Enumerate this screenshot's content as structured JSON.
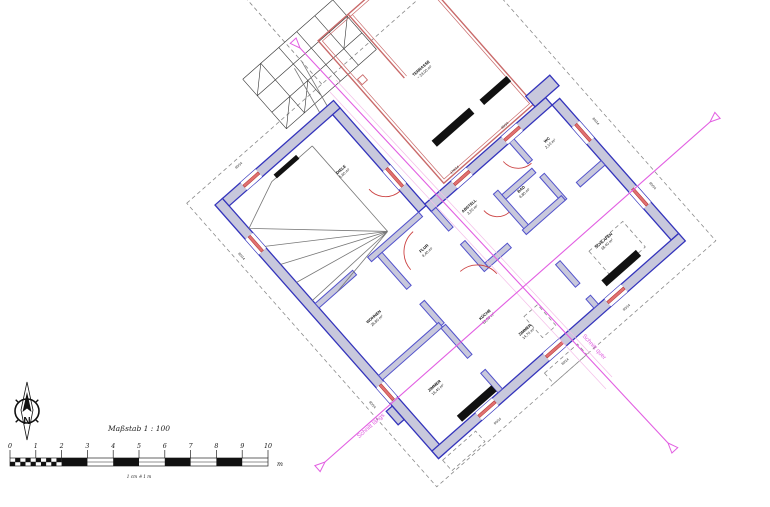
{
  "title_block": {
    "scale_title": "Maßstab 1 : 100",
    "scale_sub": "1 cm ≙ 1 m",
    "unit": "m"
  },
  "scalebar": {
    "ticks": [
      "0",
      "1",
      "2",
      "3",
      "4",
      "5",
      "6",
      "7",
      "8",
      "9",
      "10"
    ]
  },
  "compass": {
    "letter": "N"
  },
  "sections": {
    "laengs": "Schnitt längs",
    "quer": "Schnitt quer"
  },
  "colors": {
    "wall_fill": "#c8c8dc",
    "wall_edge": "#3434bc",
    "inner_edge": "#5252cc",
    "window_red": "#cc4444",
    "terrace_red": "#c96a6a",
    "section_magenta": "#e25fe2",
    "dash_gray": "#8a8a8a"
  },
  "rooms": [
    {
      "name": "TERRASSE",
      "area": "~ 23,00 m²",
      "x": 245,
      "y": 35
    },
    {
      "name": "DIELE",
      "area": "5,60 m²",
      "x": 118,
      "y": 58
    },
    {
      "name": "WOHNEN",
      "area": "26,80 m²",
      "x": 45,
      "y": 190
    },
    {
      "name": "ZIMMER",
      "area": "16,40 m²",
      "x": 45,
      "y": 282
    },
    {
      "name": "KÜCHE",
      "area": "12,60 m²",
      "x": 130,
      "y": 262
    },
    {
      "name": "FLUR",
      "area": "9,40 m²",
      "x": 128,
      "y": 172
    },
    {
      "name": "ABSTELL",
      "area": "3,20 m²",
      "x": 190,
      "y": 170
    },
    {
      "name": "BAD",
      "area": "6,80 m²",
      "x": 240,
      "y": 192
    },
    {
      "name": "WC",
      "area": "2,10 m²",
      "x": 292,
      "y": 172
    },
    {
      "name": "SCHLAFEN",
      "area": "18,40 m²",
      "x": 268,
      "y": 285
    },
    {
      "name": "ZIMMER",
      "area": "14,70 m²",
      "x": 150,
      "y": 300
    }
  ],
  "dims": [
    {
      "t": "80/14",
      "x": -15,
      "y": 56,
      "r": 90
    },
    {
      "t": "80/14",
      "x": -15,
      "y": 254,
      "r": 90
    },
    {
      "t": "80/14",
      "x": 44,
      "y": -13,
      "r": 0
    },
    {
      "t": "80/14",
      "x": 69,
      "y": 350,
      "r": 0
    },
    {
      "t": "80/14",
      "x": 159,
      "y": 350,
      "r": 0
    },
    {
      "t": "80/14",
      "x": 241,
      "y": 350,
      "r": 0
    },
    {
      "t": "80/14",
      "x": 340,
      "y": 189,
      "r": 90
    },
    {
      "t": "80/14",
      "x": 340,
      "y": 275,
      "r": 90
    },
    {
      "t": "178/14",
      "x": 203,
      "y": 133,
      "r": 0
    },
    {
      "t": "80/14",
      "x": 270,
      "y": 133,
      "r": 0
    }
  ]
}
